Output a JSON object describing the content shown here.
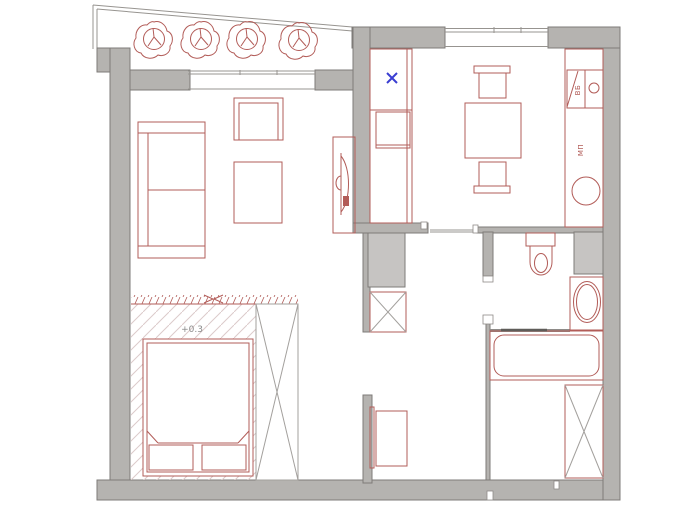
{
  "drawing": {
    "type": "apartment-floor-plan",
    "annotations": {
      "platform_elevation": "+0.3",
      "kitchen_unit_label_top": "ВБ",
      "kitchen_unit_label_mid": "МП"
    },
    "markers": {
      "hob_mark": "×",
      "balcony_plants_count": 4,
      "crossed_wardrobe_boxes_count": 3
    },
    "colors": {
      "background": "#ffffff",
      "wall_fill": "#b5b3b0",
      "wall_outline": "#7e7b78",
      "shaft_fill": "#c6c4c2",
      "furniture_line": "#b25c58",
      "hatch_line": "#dccaca",
      "accent_blue": "#3a3ed2",
      "screen_dark": "#5f5c59"
    }
  }
}
